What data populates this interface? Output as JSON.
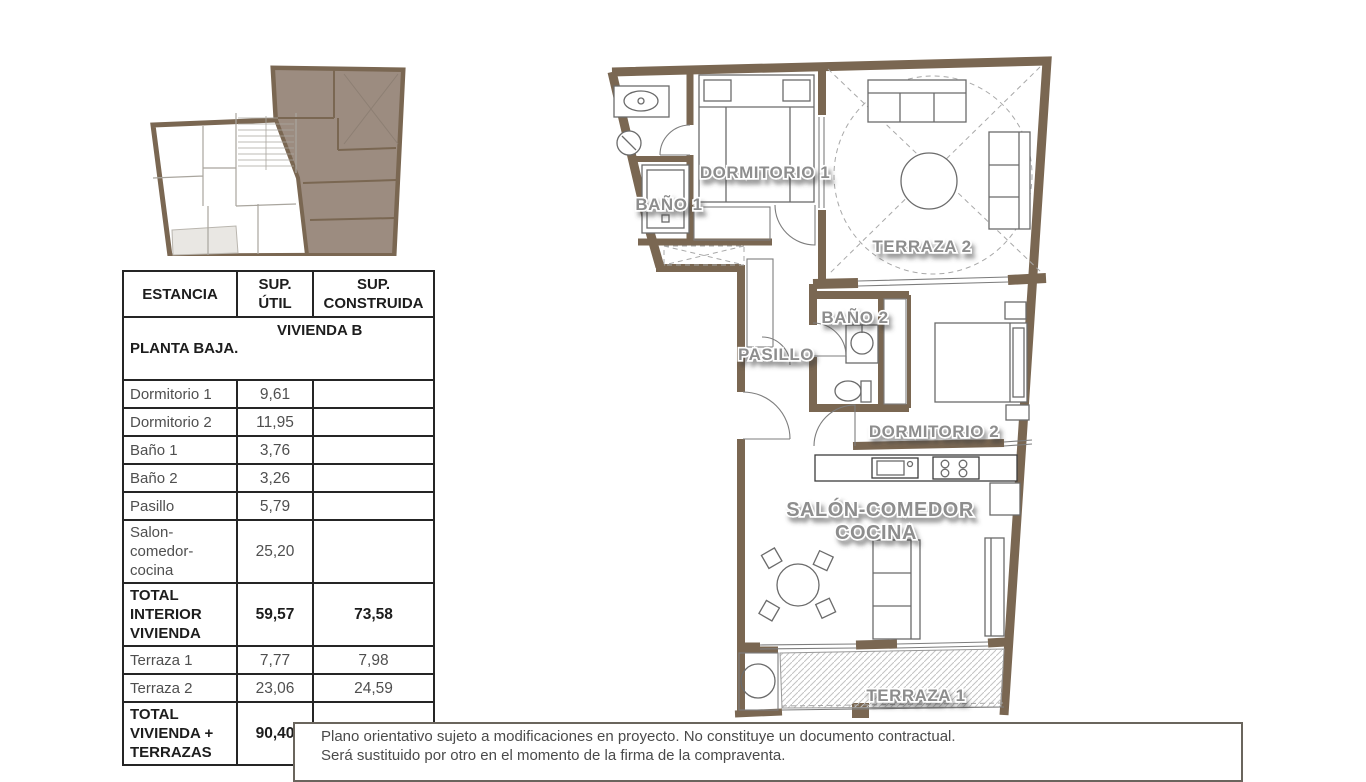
{
  "colors": {
    "wall_brown": "#7a6752",
    "unit_highlight": "#9c8c80",
    "room_label_gray": "#8d8d8d",
    "table_text_gray": "#4f4f4f"
  },
  "table": {
    "headers": [
      "ESTANCIA",
      "SUP.\nÚTIL",
      "SUP.\nCONSTRUIDA"
    ],
    "section": {
      "left": "PLANTA BAJA.",
      "right": "VIVIENDA B"
    },
    "rows": [
      {
        "cells": [
          "Dormitorio 1",
          "9,61",
          ""
        ]
      },
      {
        "cells": [
          "Dormitorio 2",
          "11,95",
          ""
        ]
      },
      {
        "cells": [
          "Baño 1",
          "3,76",
          ""
        ]
      },
      {
        "cells": [
          "Baño 2",
          "3,26",
          ""
        ]
      },
      {
        "cells": [
          "Pasillo",
          "5,79",
          ""
        ]
      },
      {
        "cells": [
          "Salon-\ncomedor-\ncocina",
          "25,20",
          ""
        ]
      },
      {
        "cells": [
          "TOTAL\nINTERIOR\nVIVIENDA",
          "59,57",
          "73,58"
        ]
      },
      {
        "cells": [
          "Terraza 1",
          "7,77",
          "7,98"
        ]
      },
      {
        "cells": [
          "Terraza 2",
          "23,06",
          "24,59"
        ]
      },
      {
        "cells": [
          "TOTAL\nVIVIENDA +\nTERRAZAS",
          "90,40",
          "106,15"
        ]
      }
    ]
  },
  "plan": {
    "rooms": {
      "bano1": "BAÑO 1",
      "dormitorio1": "DORMITORIO 1",
      "terraza2": "TERRAZA 2",
      "bano2": "BAÑO 2",
      "pasillo": "PASILLO",
      "dormitorio2": "DORMITORIO 2",
      "salon_line1": "SALÓN-COMEDOR",
      "salon_line2": "COCINA",
      "terraza1": "TERRAZA 1"
    }
  },
  "disclaimer": {
    "line1": "Plano orientativo sujeto a modificaciones en proyecto. No constituye un documento contractual.",
    "line2": "Será sustituido por otro en el momento de la firma de la compraventa."
  }
}
